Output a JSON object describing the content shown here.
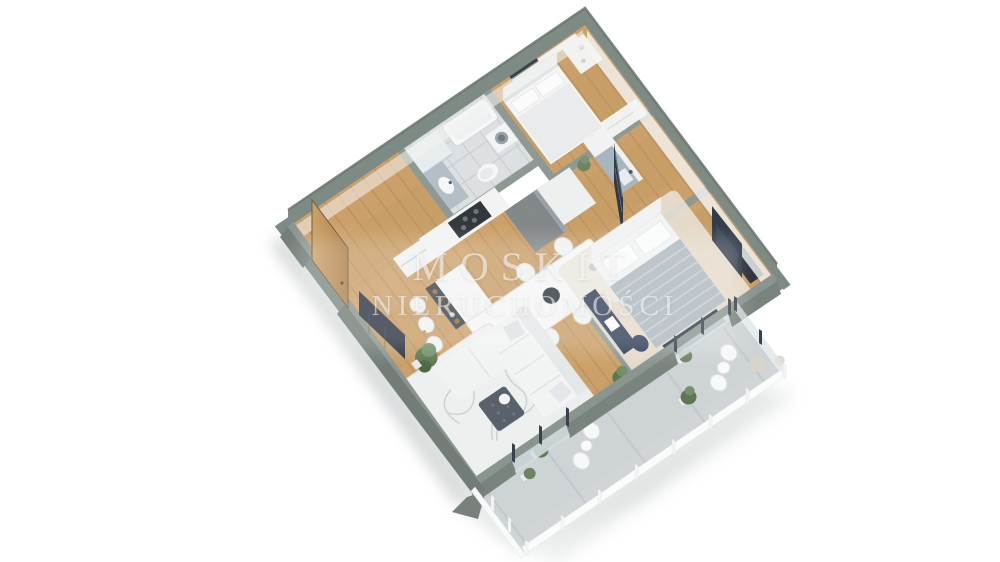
{
  "scene": {
    "description": "3D isometric floor-plan rendering of an apartment with balcony",
    "background_color": "#ffffff"
  },
  "watermark": {
    "line1": "MOSKIT",
    "line2": "NIERUCHOMOŚCI"
  },
  "palette": {
    "wall_top": "#7e8a84",
    "wall_outer_face": "#727d77",
    "wall_inner_face": "#f2f3f2",
    "partition": "#8f9993",
    "wood_floor": "#c89e67",
    "wood_plank_line": "#b2875a",
    "tile_floor": "#dde0e2",
    "concrete_floor": "#ced3d5",
    "sofa_white": "#f2f4f4",
    "rug_white": "#eef0ef",
    "accent_navy": "#2f3a50",
    "duvet_gray": "#aeb8c0",
    "kitchen_blue_gray": "#a7b6c0",
    "island_dark": "#3b434b",
    "bottle_amber": "#9a6c33",
    "plant_green": "#6d8560",
    "ottoman_slate": "#59626c",
    "door_wood": "#c59a5f",
    "glass": "#d6dfe2",
    "railing_white": "#fafbfb",
    "shadow": "#d4d7d8"
  },
  "rooms": [
    {
      "name": "bedroom-2",
      "furniture": [
        "double-bed",
        "headboard",
        "wardrobe",
        "curtains",
        "dresser",
        "tv-strip"
      ]
    },
    {
      "name": "bathroom",
      "furniture": [
        "bathtub",
        "shower",
        "washing-machine",
        "vanity-sink",
        "toilet"
      ]
    },
    {
      "name": "hallway",
      "furniture": [
        "entrance-door",
        "mirror-wardrobe",
        "navy-shelving-unit"
      ]
    },
    {
      "name": "kitchen",
      "furniture": [
        "blue-gray-cabinets",
        "sink",
        "tall-cabinets",
        "cooktop",
        "gray-canopy",
        "bar-island",
        "bottle-shelf",
        "bar-stools"
      ]
    },
    {
      "name": "dining-area",
      "furniture": [
        "dining-table",
        "side-chairs",
        "pendant-lamp",
        "centerpiece"
      ]
    },
    {
      "name": "living-room",
      "furniture": [
        "corner-sofa",
        "patterned-rug",
        "ottoman-coffee-table",
        "tv-cabinet",
        "floor-plants"
      ]
    },
    {
      "name": "master-bedroom",
      "furniture": [
        "double-bed",
        "striped-duvet",
        "headboard",
        "tv-panel",
        "navy-desk",
        "office-chair",
        "cream-rug",
        "balcony-door"
      ]
    },
    {
      "name": "balcony",
      "furniture": [
        "wire-chairs",
        "round-tables",
        "potted-plants",
        "pampas-grass",
        "slat-railing",
        "glass-doors"
      ]
    }
  ]
}
